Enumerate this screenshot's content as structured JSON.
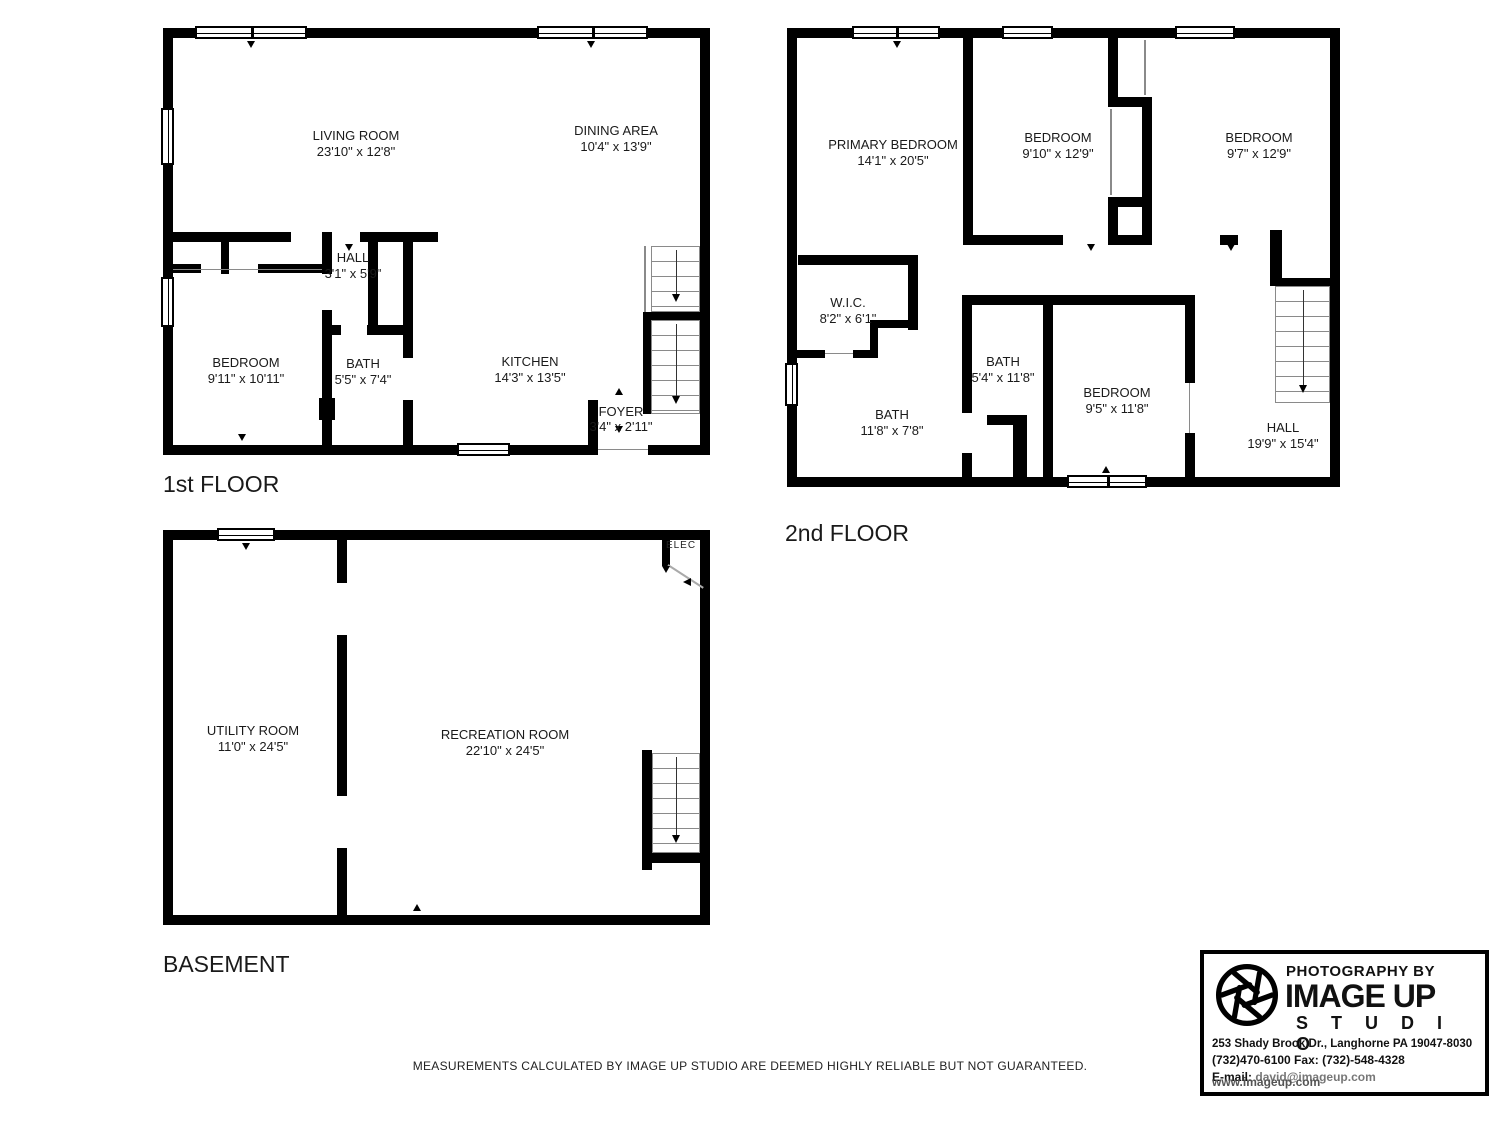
{
  "colors": {
    "wall": "#000000",
    "background": "#ffffff",
    "thin_line": "#8a8a8a"
  },
  "floors": [
    {
      "label": "1st FLOOR",
      "rooms": [
        {
          "name": "LIVING ROOM",
          "dims": "23'10\" x 12'8\""
        },
        {
          "name": "DINING AREA",
          "dims": "10'4\" x 13'9\""
        },
        {
          "name": "HALL",
          "dims": "3'1\" x 5'9\""
        },
        {
          "name": "BEDROOM",
          "dims": "9'11\" x 10'11\""
        },
        {
          "name": "BATH",
          "dims": "5'5\" x 7'4\""
        },
        {
          "name": "KITCHEN",
          "dims": "14'3\" x 13'5\""
        },
        {
          "name": "FOYER",
          "dims": "3'4\" x 2'11\""
        }
      ]
    },
    {
      "label": "2nd FLOOR",
      "rooms": [
        {
          "name": "PRIMARY BEDROOM",
          "dims": "14'1\" x 20'5\""
        },
        {
          "name": "BEDROOM",
          "dims": "9'10\" x 12'9\""
        },
        {
          "name": "BEDROOM",
          "dims": "9'7\" x 12'9\""
        },
        {
          "name": "W.I.C.",
          "dims": "8'2\" x 6'1\""
        },
        {
          "name": "BATH",
          "dims": "11'8\" x 7'8\""
        },
        {
          "name": "BATH",
          "dims": "5'4\" x 11'8\""
        },
        {
          "name": "BEDROOM",
          "dims": "9'5\" x 11'8\""
        },
        {
          "name": "HALL",
          "dims": "19'9\" x 15'4\""
        }
      ]
    },
    {
      "label": "BASEMENT",
      "elec": "ELEC",
      "rooms": [
        {
          "name": "UTILITY ROOM",
          "dims": "11'0\" x 24'5\""
        },
        {
          "name": "RECREATION ROOM",
          "dims": "22'10\" x 24'5\""
        }
      ]
    }
  ],
  "logo": {
    "tagline": "PHOTOGRAPHY BY",
    "brand": "IMAGE UP",
    "brand_sub": "S T U D I O",
    "address": "253 Shady Brook Dr., Langhorne PA 19047-8030",
    "phone_fax": "(732)470-6100 Fax: (732)-548-4328",
    "email_label": "E-mail:",
    "email_value": "david@imageup.com",
    "website": "www.imageup.com"
  },
  "disclaimer": "MEASUREMENTS CALCULATED BY IMAGE UP STUDIO ARE DEEMED HIGHLY RELIABLE BUT NOT GUARANTEED."
}
